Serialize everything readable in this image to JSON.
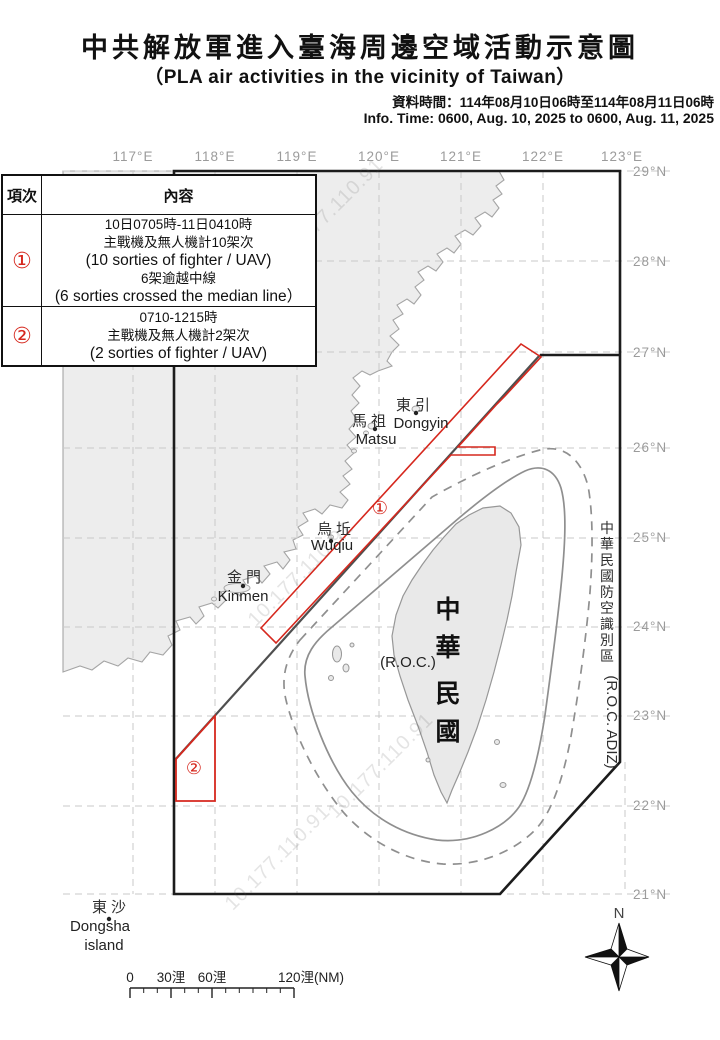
{
  "header": {
    "title": "中共解放軍進入臺海周邊空域活動示意圖",
    "subtitle": "（PLA air activities in the vicinity of Taiwan）",
    "info_zh": "資料時間：114年08月10日06時至114年08月11日06時",
    "info_en": "Info. Time: 0600, Aug. 10, 2025 to 0600, Aug. 11, 2025"
  },
  "table": {
    "headers": [
      "項次",
      "內容"
    ],
    "rows": [
      {
        "id": "①",
        "lines": [
          "10日0705時-11日0410時",
          "主戰機及無人機計10架次",
          "(10 sorties of  fighter / UAV)",
          "6架逾越中線",
          "(6 sorties crossed the median line）"
        ]
      },
      {
        "id": "②",
        "lines": [
          "0710-1215時",
          "主戰機及無人機計2架次",
          "(2 sorties of fighter / UAV)"
        ]
      }
    ]
  },
  "axes": {
    "lon": [
      "117°E",
      "118°E",
      "119°E",
      "120°E",
      "121°E",
      "122°E",
      "123°E"
    ],
    "lat": [
      "29°N",
      "28°N",
      "27°N",
      "26°N",
      "25°N",
      "24°N",
      "23°N",
      "22°N",
      "21°N"
    ]
  },
  "places": {
    "dongyin_zh": "東引",
    "dongyin_en": "Dongyin",
    "matsu_zh": "馬祖",
    "matsu_en": "Matsu",
    "wuqiu_zh": "烏坵",
    "wuqiu_en": "Wuqiu",
    "kinmen_zh": "金門",
    "kinmen_en": "Kinmen",
    "dongsha_zh": "東沙",
    "dongsha_en1": "Dongsha",
    "dongsha_en2": "island",
    "taiwan_chars": [
      "中",
      "華",
      "民",
      "國"
    ],
    "roc": "(R.O.C.)"
  },
  "adiz": {
    "chars": [
      "中",
      "華",
      "民",
      "國",
      "防",
      "空",
      "識",
      "別",
      "區"
    ],
    "en": "(R.O.C. ADIZ)"
  },
  "areas": {
    "a1": "①",
    "a2": "②"
  },
  "scalebar": {
    "zero": "0",
    "l30": "30浬",
    "l60": "60浬",
    "l120": "120浬(NM)"
  },
  "compass": {
    "n": "N"
  },
  "watermark": "10.177.110.91",
  "colors": {
    "red": "#d6281e",
    "land": "#ededed",
    "coast": "#a5a5a5",
    "grid": "#c9c9c9",
    "border": "#1c1c1c",
    "median": "#4f4f4f",
    "loop": "#8f8f8f"
  }
}
